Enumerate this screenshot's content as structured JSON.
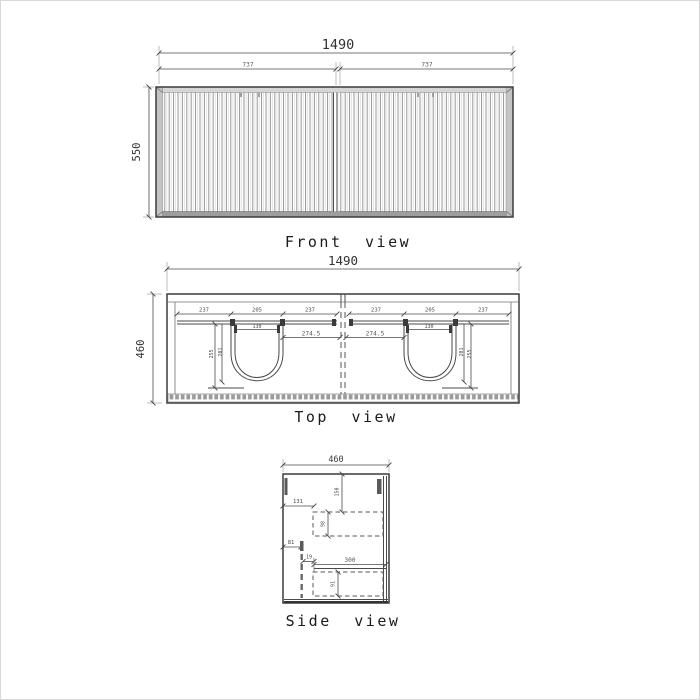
{
  "drawing": {
    "front_view": {
      "label": "Front view",
      "overall_width": "1490",
      "half_width_left": "737",
      "half_width_right": "737",
      "height": "550"
    },
    "top_view": {
      "label": "Top view",
      "overall_width": "1490",
      "depth": "460",
      "left_basin": {
        "chain": [
          "237",
          "205",
          "237"
        ],
        "faucet_hole": "130",
        "to_center": "274.5",
        "depth_outer": "255",
        "depth_inner": "201"
      },
      "right_basin": {
        "chain": [
          "237",
          "205",
          "237"
        ],
        "faucet_hole": "130",
        "to_center": "274.5",
        "depth_outer": "255",
        "depth_inner": "201"
      }
    },
    "side_view": {
      "label": "Side view",
      "depth": "460",
      "back_clearance": "150",
      "top_offset": "131",
      "top_drawer_height": "98",
      "left_offset": "81",
      "front_gap": "19",
      "drawer_width": "300",
      "bottom_drawer_height": "91"
    }
  }
}
